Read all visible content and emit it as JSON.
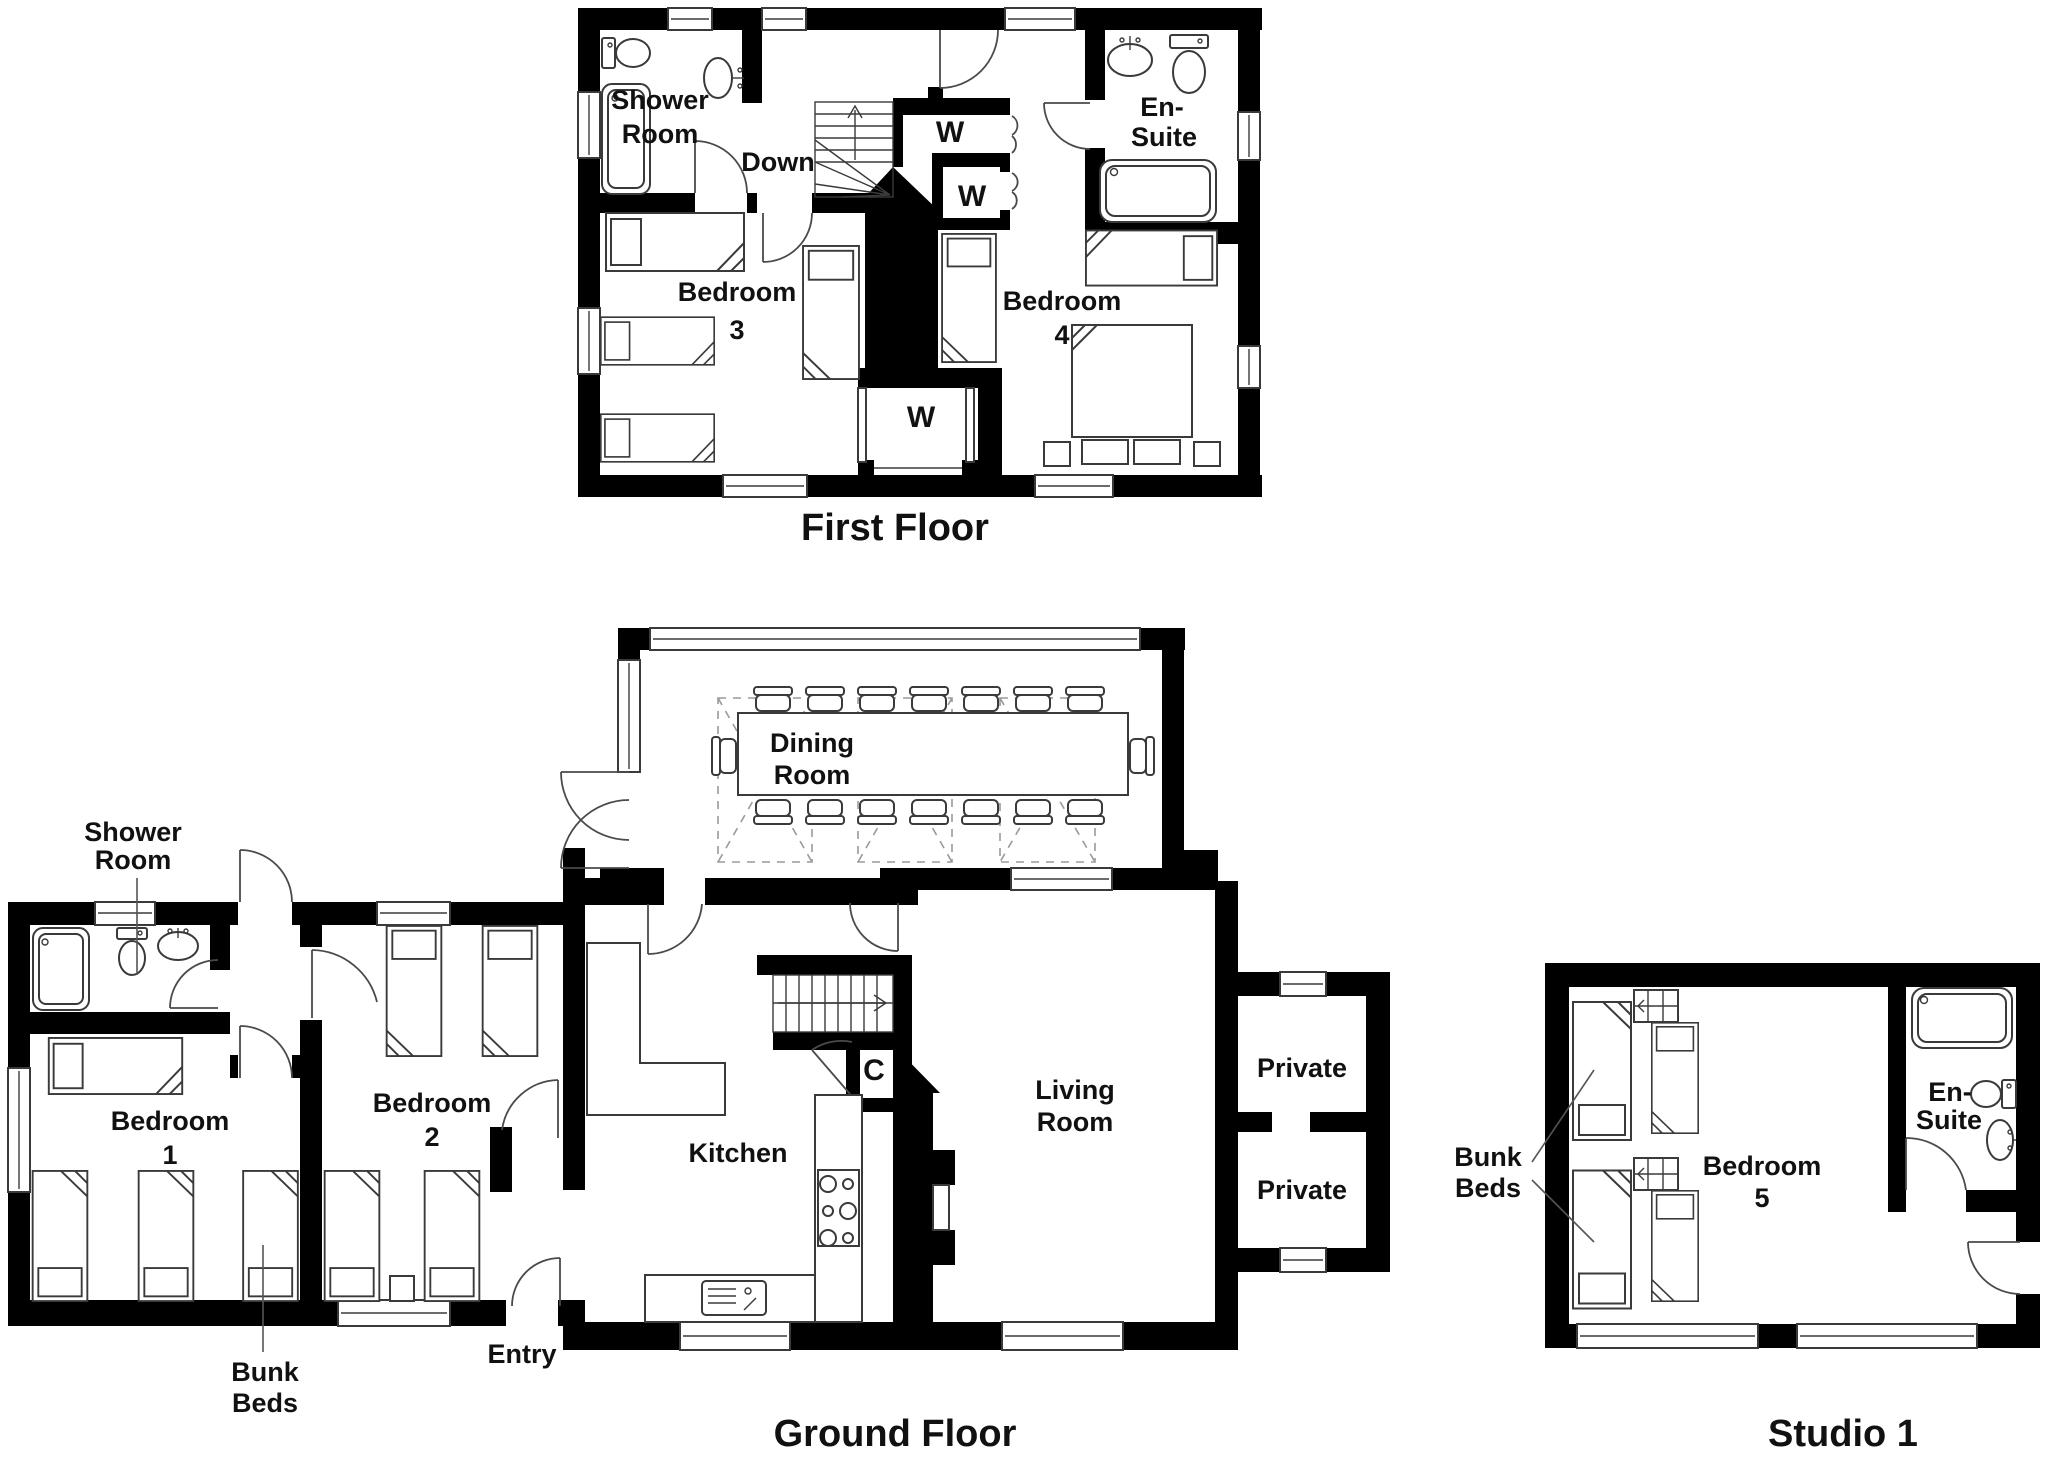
{
  "document_type": "property floor plan set",
  "colors": {
    "wall": "#000000",
    "furniture_line": "#3a3a3a",
    "skylight_dash": "#9a9a9a",
    "background": "#ffffff",
    "text": "#111111"
  },
  "floors": {
    "first_floor": {
      "title": "First Floor",
      "labels": {
        "shower_room": [
          "Shower",
          "Room"
        ],
        "down": "Down",
        "closet_w1": "W",
        "closet_w2": "W",
        "closet_w3": "W",
        "en_suite": [
          "En-",
          "Suite"
        ],
        "bedroom3": [
          "Bedroom",
          "3"
        ],
        "bedroom4": [
          "Bedroom",
          "4"
        ]
      }
    },
    "ground_floor": {
      "title": "Ground Floor",
      "labels": {
        "shower_room": [
          "Shower",
          "Room"
        ],
        "dining_room": [
          "Dining",
          "Room"
        ],
        "bedroom1": [
          "Bedroom",
          "1"
        ],
        "bedroom2": [
          "Bedroom",
          "2"
        ],
        "bunk_beds": [
          "Bunk",
          "Beds"
        ],
        "entry": "Entry",
        "kitchen": "Kitchen",
        "closet_c": "C",
        "living_room": [
          "Living",
          "Room"
        ],
        "private_top": "Private",
        "private_bottom": "Private"
      }
    },
    "studio": {
      "title": "Studio 1",
      "labels": {
        "bunk_beds": [
          "Bunk",
          "Beds"
        ],
        "bedroom5": [
          "Bedroom",
          "5"
        ],
        "en_suite": [
          "En-",
          "Suite"
        ]
      }
    }
  }
}
